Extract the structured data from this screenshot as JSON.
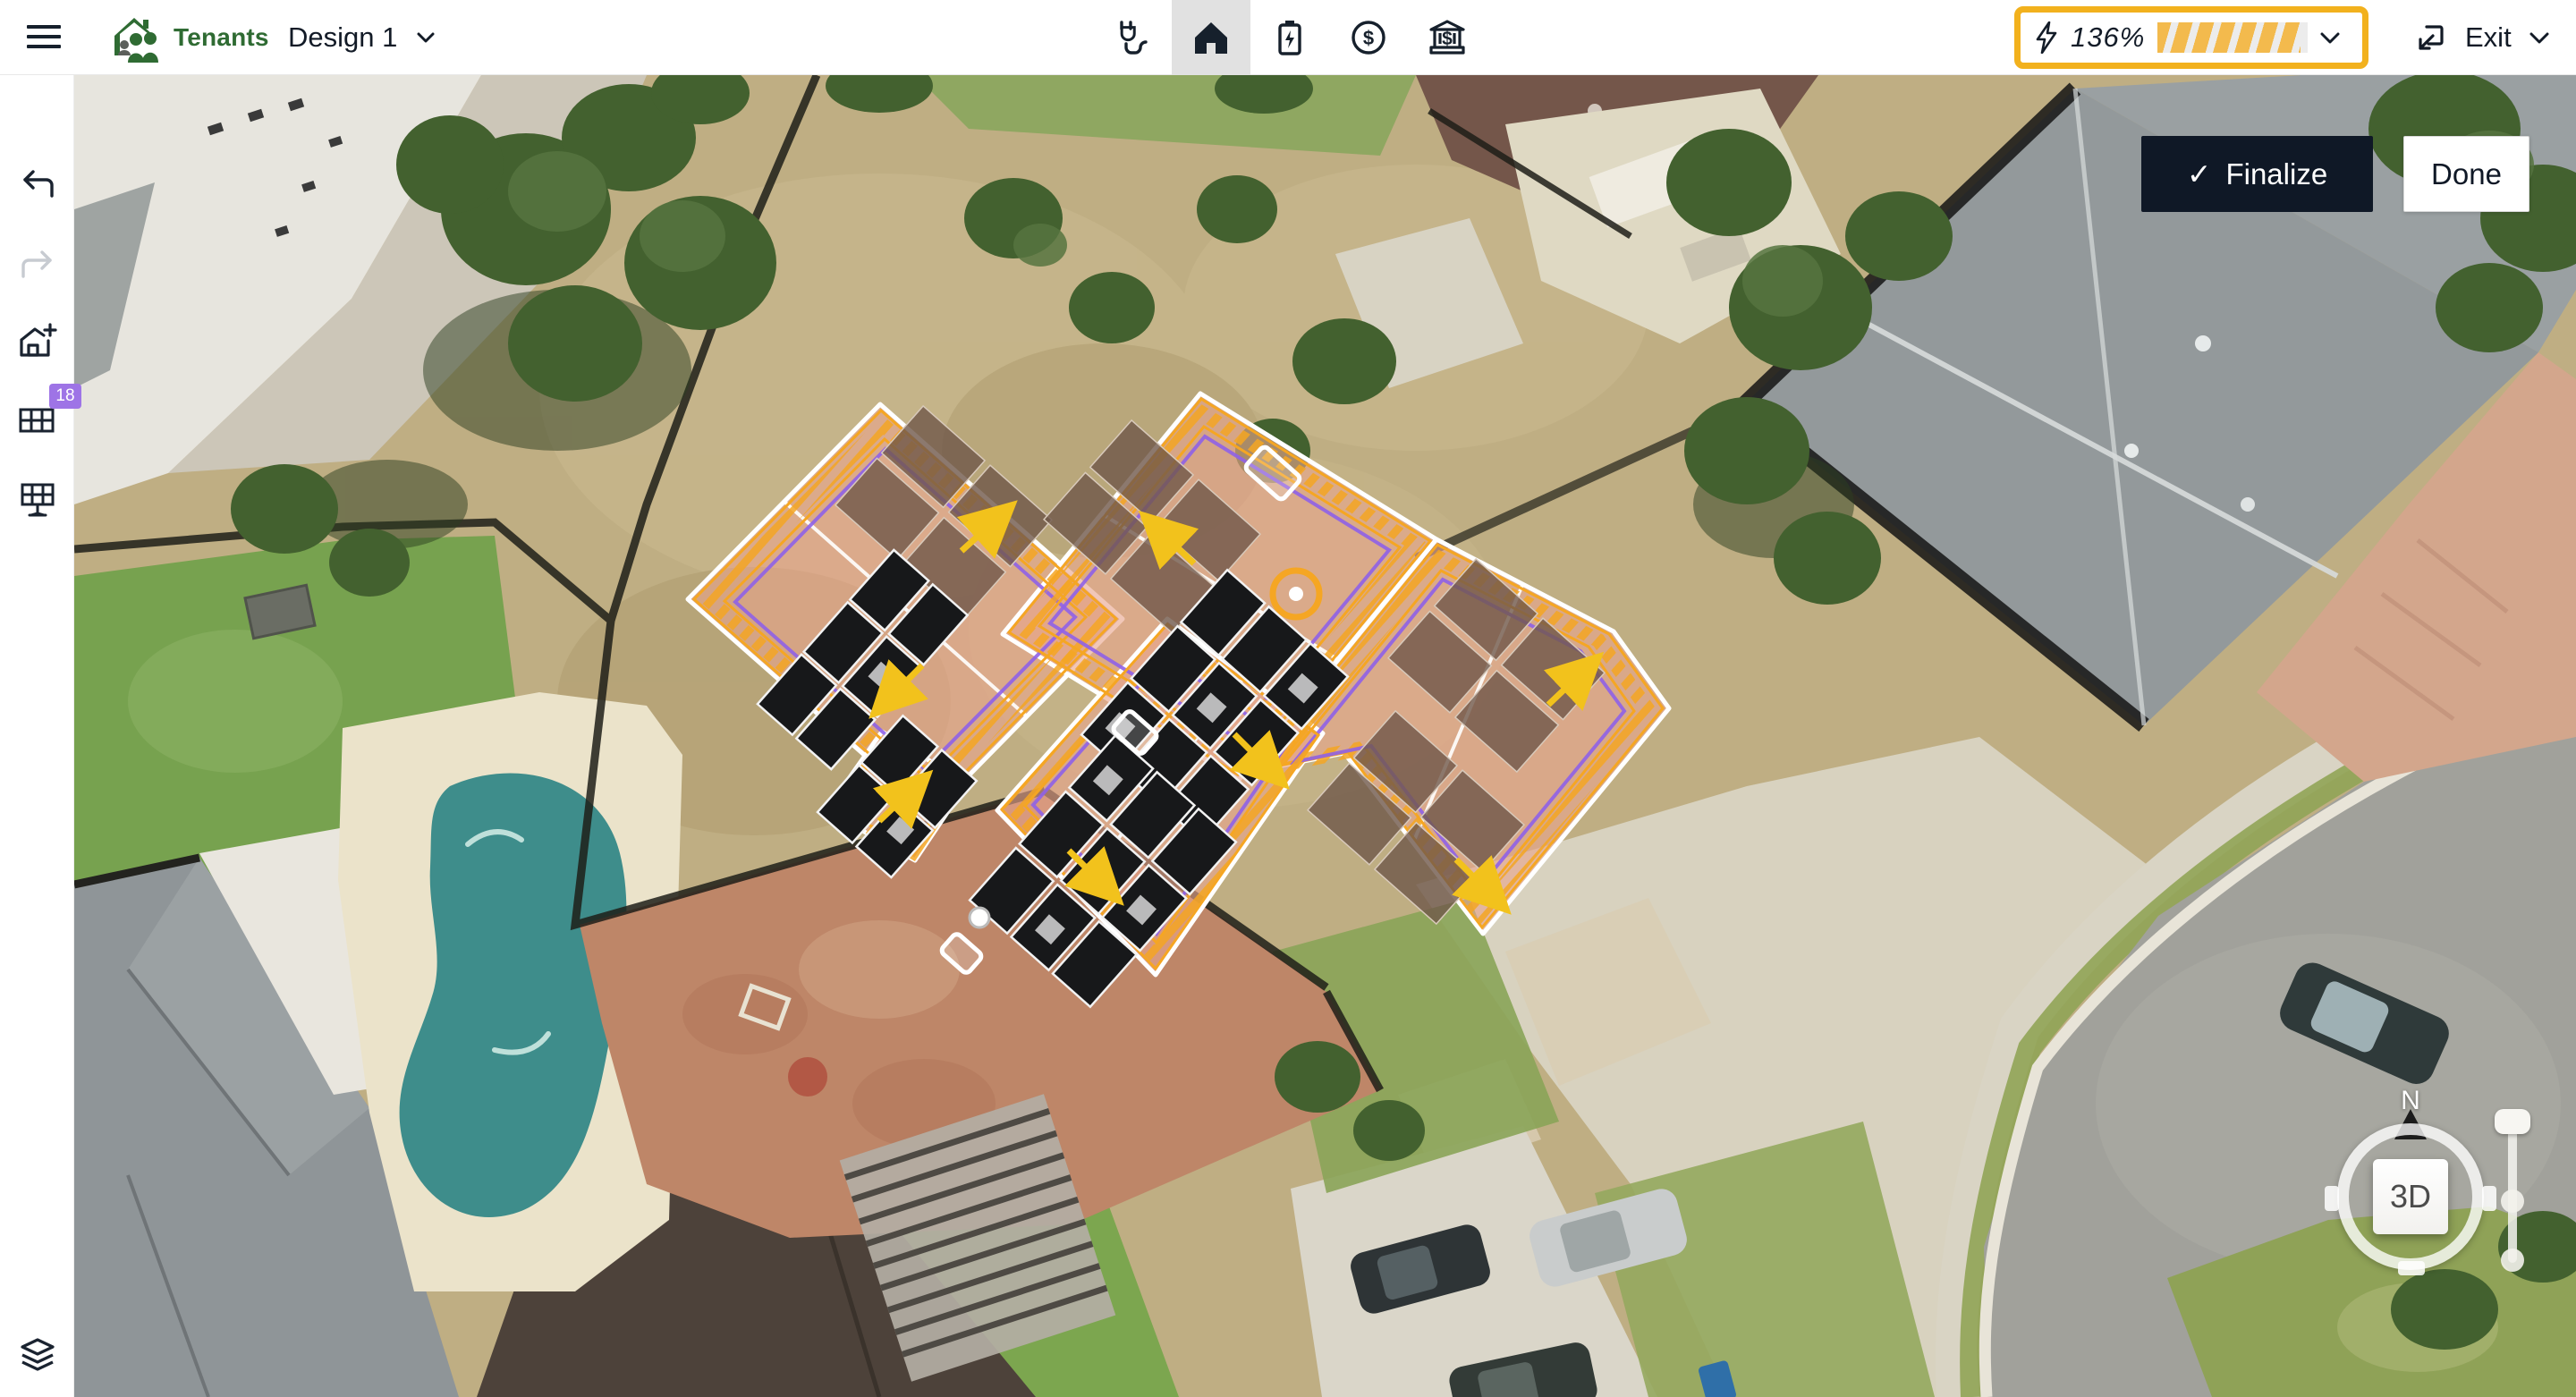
{
  "topbar": {
    "logo_text": "Tenants",
    "design_selector_label": "Design 1",
    "tools": [
      {
        "name": "consumption-plug",
        "active": false
      },
      {
        "name": "home-design",
        "active": true
      },
      {
        "name": "battery-storage",
        "active": false
      },
      {
        "name": "pricing-dollar",
        "active": false
      },
      {
        "name": "incentives-bank",
        "active": false
      }
    ],
    "production_meter": {
      "value": "136%",
      "fill_fraction": 0.95,
      "highlighted": true
    },
    "exit_label": "Exit"
  },
  "sidebar": {
    "badge_count": "18",
    "tools": [
      "undo",
      "redo",
      "add-structure",
      "panel-array",
      "solar-table",
      "layers"
    ]
  },
  "overlay": {
    "finalize_label": "Finalize",
    "finalize_check": "✓",
    "done_label": "Done",
    "compass_north": "N",
    "mode_3d": "3D"
  },
  "colors": {
    "accent_gold": "#F2B11D",
    "meter_stripe": "#F3BA4D",
    "badge_purple": "#9E74E6",
    "ink": "#16202C",
    "active_tool_bg": "#E1E1E1",
    "logo_green": "#2F6B33",
    "roof_tint_salmon": "#E9A48D",
    "setback_orange": "#F5A623",
    "eave_purple": "#8F62E8",
    "panel_black": "#17181A",
    "module_brown": "#6F584A",
    "arrow_yellow": "#F2C21C",
    "finalize_bg": "#0F1826"
  }
}
